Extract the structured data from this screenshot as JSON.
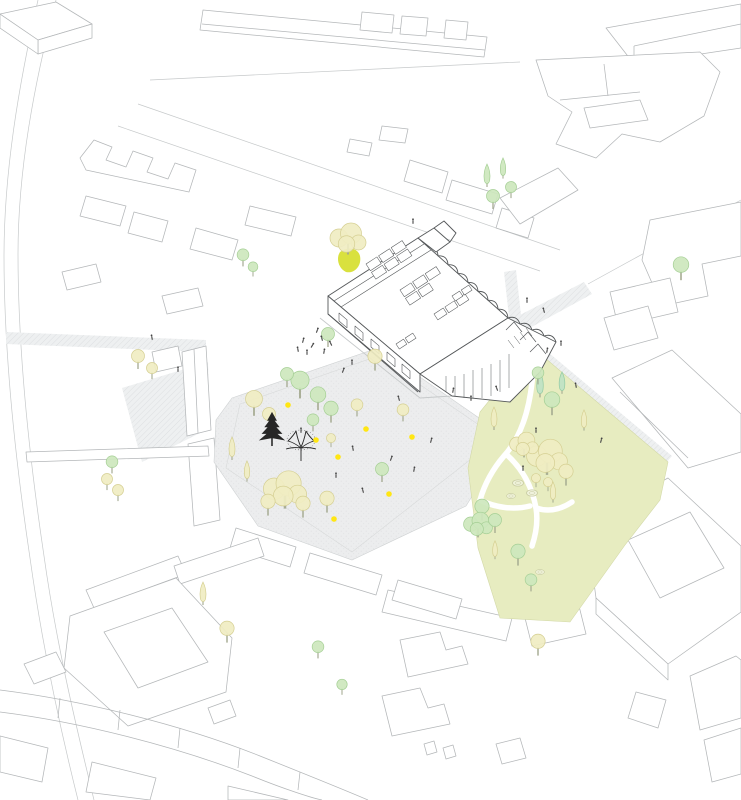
{
  "scene": {
    "width": 741,
    "height": 800,
    "background": "#ffffff",
    "kind": "axonometric-architectural-site-plan"
  },
  "palette": {
    "context_line": "#b4b7b9",
    "context_line_light": "#c6c9ca",
    "building_line": "#55585a",
    "building_fill": "#ffffff",
    "plaza_fill": "#ecedee",
    "plaza_edge": "#cfd2d3",
    "street_hatch": "#e8eaec",
    "park_fill": "#e7ecc0",
    "park_edge": "#d3d9a8",
    "park_path": "#ffffff",
    "tree_pale_yellow": "#f0edc2",
    "tree_pale_yellow_edge": "#d5cf92",
    "tree_light_green": "#cde7bd",
    "tree_light_green_edge": "#a5cf95",
    "tree_teal_green": "#bfe2c4",
    "tree_teal_green_edge": "#93cba4",
    "highlight_patch": "#d9e13e",
    "dot_yellow": "#ffe614",
    "black_tree": "#262626",
    "figure": "#454545"
  },
  "plaza": {
    "dots": [
      [
        288,
        405
      ],
      [
        316,
        440
      ],
      [
        338,
        457
      ],
      [
        366,
        429
      ],
      [
        412,
        437
      ],
      [
        389,
        494
      ],
      [
        334,
        519
      ]
    ]
  },
  "trees": [
    [
      "cyp",
      "t",
      540,
      393,
      1.1
    ],
    [
      "cyp",
      "t",
      562,
      390,
      0.95
    ],
    [
      "round",
      "g",
      552,
      408,
      1.2
    ],
    [
      "round",
      "g",
      538,
      379,
      0.9
    ],
    [
      "cyp",
      "y",
      494,
      426,
      1.0
    ],
    [
      "cyp",
      "y",
      584,
      427,
      0.9
    ],
    [
      "cloud",
      "y",
      547,
      463,
      1.7
    ],
    [
      "cloud",
      "y",
      524,
      449,
      1.2
    ],
    [
      "round",
      "y",
      566,
      479,
      1.1
    ],
    [
      "round",
      "y",
      536,
      483,
      0.7
    ],
    [
      "round",
      "y",
      548,
      487,
      0.7
    ],
    [
      "shrub",
      "y",
      518,
      483,
      1.0
    ],
    [
      "shrub",
      "y",
      532,
      493,
      1.0
    ],
    [
      "shrub",
      "y",
      511,
      496,
      0.8
    ],
    [
      "round",
      "g",
      482,
      514,
      1.1
    ],
    [
      "cloud",
      "g",
      478,
      529,
      1.2
    ],
    [
      "round",
      "g",
      495,
      527,
      1.0
    ],
    [
      "cyp",
      "y",
      553,
      499,
      0.9
    ],
    [
      "round",
      "g",
      518,
      559,
      1.1
    ],
    [
      "cyp",
      "y",
      495,
      556,
      0.8
    ],
    [
      "round",
      "g",
      531,
      586,
      0.9
    ],
    [
      "shrub",
      "y",
      540,
      572,
      0.8
    ],
    [
      "round",
      "g",
      300,
      390,
      1.4
    ],
    [
      "round",
      "g",
      318,
      403,
      1.2
    ],
    [
      "round",
      "g",
      287,
      381,
      1.0
    ],
    [
      "round",
      "g",
      331,
      416,
      1.1
    ],
    [
      "round",
      "g",
      313,
      426,
      0.9
    ],
    [
      "round",
      "y",
      254,
      408,
      1.3
    ],
    [
      "round",
      "y",
      269,
      421,
      1.0
    ],
    [
      "cyp",
      "y",
      232,
      456,
      1.0
    ],
    [
      "cyp",
      "y",
      247,
      478,
      0.9
    ],
    [
      "cloud",
      "y",
      285,
      496,
      1.8
    ],
    [
      "round",
      "y",
      268,
      509,
      1.1
    ],
    [
      "round",
      "y",
      303,
      511,
      1.1
    ],
    [
      "round",
      "y",
      327,
      506,
      1.1
    ],
    [
      "round",
      "y",
      357,
      411,
      0.9
    ],
    [
      "round",
      "y",
      403,
      416,
      0.9
    ],
    [
      "round",
      "g",
      382,
      476,
      1.0
    ],
    [
      "round",
      "y",
      331,
      443,
      0.7
    ],
    [
      "round",
      "y",
      138,
      363,
      1.0
    ],
    [
      "round",
      "y",
      152,
      374,
      0.85
    ],
    [
      "round",
      "g",
      112,
      468,
      0.9
    ],
    [
      "round",
      "y",
      107,
      485,
      0.85
    ],
    [
      "round",
      "y",
      118,
      496,
      0.85
    ],
    [
      "cloud",
      "y",
      348,
      244,
      1.5
    ],
    [
      "round",
      "g",
      328,
      341,
      1.0
    ],
    [
      "round",
      "y",
      375,
      364,
      1.1
    ],
    [
      "round",
      "g",
      243,
      261,
      0.9
    ],
    [
      "round",
      "g",
      253,
      272,
      0.75
    ],
    [
      "cyp",
      "g",
      487,
      183,
      1.0
    ],
    [
      "cyp",
      "g",
      503,
      175,
      0.9
    ],
    [
      "round",
      "g",
      493,
      203,
      1.0
    ],
    [
      "round",
      "g",
      511,
      193,
      0.85
    ],
    [
      "round",
      "g",
      681,
      273,
      1.2
    ],
    [
      "cyp",
      "y",
      203,
      601,
      1.0
    ],
    [
      "round",
      "y",
      227,
      636,
      1.1
    ],
    [
      "round",
      "y",
      538,
      649,
      1.1
    ],
    [
      "round",
      "g",
      318,
      653,
      0.9
    ],
    [
      "round",
      "g",
      342,
      690,
      0.8
    ]
  ],
  "black_trees": [
    [
      "pine",
      272,
      446,
      1.1
    ],
    [
      "deciduous",
      301,
      461,
      1.0
    ]
  ],
  "figures": [
    [
      317,
      331,
      20
    ],
    [
      322,
      339,
      -15
    ],
    [
      312,
      346,
      30
    ],
    [
      307,
      353,
      0
    ],
    [
      324,
      352,
      10
    ],
    [
      331,
      344,
      -25
    ],
    [
      303,
      341,
      15
    ],
    [
      298,
      350,
      -10
    ],
    [
      352,
      363,
      0
    ],
    [
      343,
      371,
      20
    ],
    [
      399,
      399,
      -15
    ],
    [
      453,
      391,
      10
    ],
    [
      471,
      399,
      0
    ],
    [
      497,
      389,
      -20
    ],
    [
      431,
      441,
      15
    ],
    [
      301,
      431,
      0
    ],
    [
      353,
      449,
      -10
    ],
    [
      391,
      459,
      20
    ],
    [
      336,
      476,
      0
    ],
    [
      363,
      491,
      -15
    ],
    [
      414,
      470,
      10
    ],
    [
      536,
      431,
      0
    ],
    [
      576,
      386,
      -10
    ],
    [
      601,
      441,
      15
    ],
    [
      523,
      469,
      0
    ],
    [
      527,
      301,
      0
    ],
    [
      544,
      311,
      -15
    ],
    [
      547,
      351,
      10
    ],
    [
      561,
      344,
      0
    ],
    [
      413,
      222,
      0
    ],
    [
      178,
      370,
      0
    ],
    [
      152,
      338,
      -10
    ]
  ]
}
